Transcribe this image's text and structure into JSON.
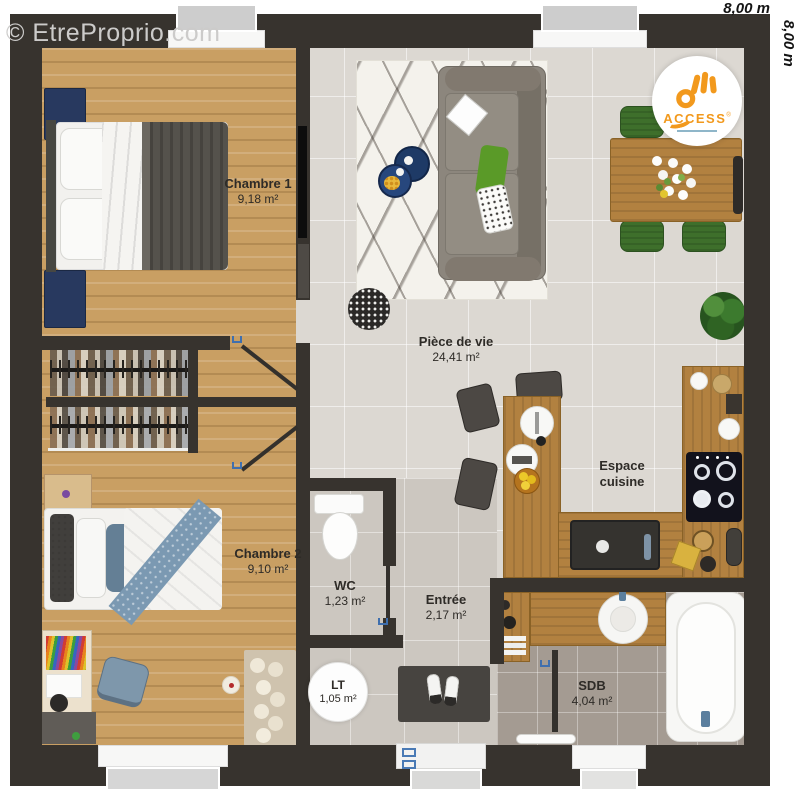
{
  "watermark": {
    "text": "© EtreProprio.com"
  },
  "dimensions": {
    "top": "8,00 m",
    "right": "8,00 m"
  },
  "logo": {
    "brand": "ACCESS",
    "reg": "®"
  },
  "rooms": {
    "chambre1": {
      "name": "Chambre 1",
      "area": "9,18 m²"
    },
    "chambre2": {
      "name": "Chambre 2",
      "area": "9,10 m²"
    },
    "piece_de_vie": {
      "name": "Pièce de vie",
      "area": "24,41 m²"
    },
    "wc": {
      "name": "WC",
      "area": "1,23 m²"
    },
    "entree": {
      "name": "Entrée",
      "area": "2,17 m²"
    },
    "lt": {
      "name": "LT",
      "area": "1,05 m²"
    },
    "cuisine": {
      "name": "Espace cuisine",
      "area": ""
    },
    "sdb": {
      "name": "SDB",
      "area": "4,04 m²"
    }
  },
  "colors": {
    "wall": "#37332e",
    "wood_floor": "#c99f63",
    "tile_light": "#dcd8d2",
    "tile_entree": "#ccc7c0",
    "tile_sdb": "#a49b92",
    "counter_wood": "#b28140",
    "accent_navy": "#28395f",
    "accent_green": "#3e6f2b",
    "accent_blue": "#3f6fae",
    "logo_orange": "#f2991d"
  }
}
